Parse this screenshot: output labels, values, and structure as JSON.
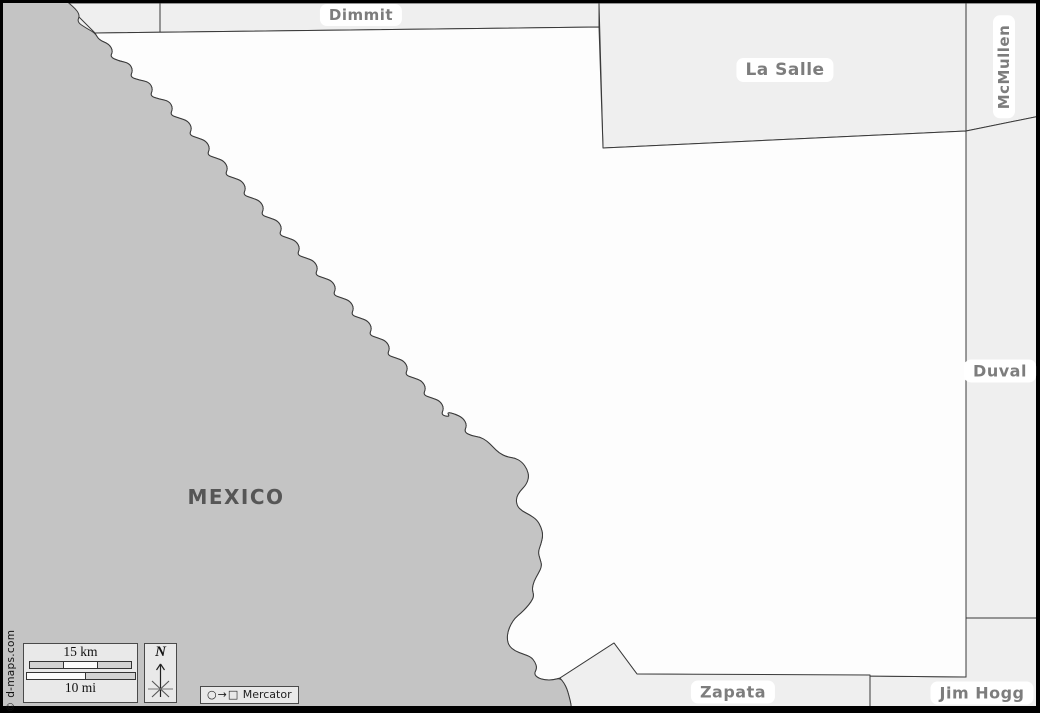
{
  "map": {
    "labels": {
      "dimmit": "Dimmit",
      "la_salle": "La Salle",
      "mcmullen": "McMullen",
      "duval": "Duval",
      "jim_hogg": "Jim Hogg",
      "zapata": "Zapata",
      "mexico": "MEXICO"
    }
  },
  "scale": {
    "km_label": "15 km",
    "mi_label": "10 mi"
  },
  "compass": {
    "north_label": "N"
  },
  "projection": {
    "icons": "○→□",
    "name": "Mercator"
  },
  "copyright": "© d-maps.com",
  "colors": {
    "mexico_fill": "#c4c4c4",
    "neighbor_fill": "#efefef",
    "county_fill": "#fdfdfd",
    "border": "#3a3a3a",
    "label_text": "#7d7d7d",
    "mexico_label": "#565656",
    "panel_bg": "#e9e9e9",
    "panel_border": "#4a4a4a",
    "frame": "#000000"
  }
}
